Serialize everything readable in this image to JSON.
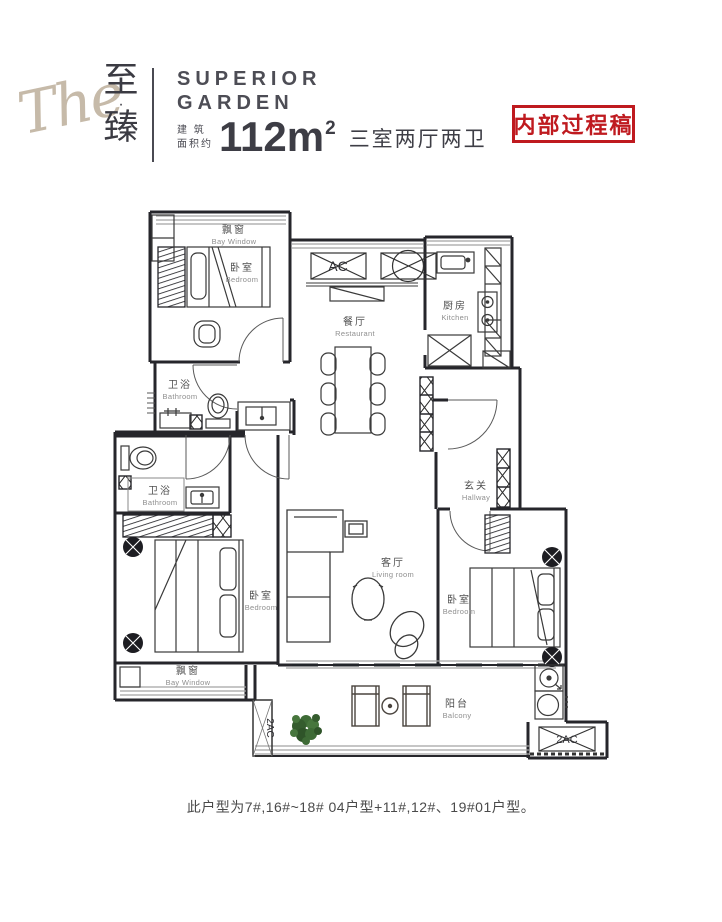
{
  "header": {
    "logo": {
      "script": "The",
      "cn_top": "至",
      "cn_dot": "·",
      "cn_bottom": "臻"
    },
    "brand": {
      "line1": "SUPERIOR",
      "line2": "GARDEN"
    },
    "area": {
      "prefix_line1": "建 筑",
      "prefix_line2": "面积约",
      "value": "112m",
      "sup": "2",
      "rooms": "三室两厅两卫"
    },
    "stamp": {
      "text": "内部过程稿",
      "color": "#bf1a1f"
    }
  },
  "floorplan": {
    "labels": {
      "bay_window_top": {
        "cn": "飘窗",
        "en": "Bay Window"
      },
      "bedroom_top_left": {
        "cn": "卧室",
        "en": "Bedroom"
      },
      "restaurant": {
        "cn": "餐厅",
        "en": "Restaurant"
      },
      "kitchen": {
        "cn": "厨房",
        "en": "Kitchen"
      },
      "bathroom_upper": {
        "cn": "卫浴",
        "en": "Bathroom"
      },
      "bathroom_lower": {
        "cn": "卫浴",
        "en": "Bathroom"
      },
      "hallway": {
        "cn": "玄关",
        "en": "Hallway"
      },
      "bedroom_bottom_left": {
        "cn": "卧室",
        "en": "Bedroom"
      },
      "living_room": {
        "cn": "客厅",
        "en": "Living room"
      },
      "bedroom_bottom_right": {
        "cn": "卧室",
        "en": "Bedroom"
      },
      "bay_window_bottom": {
        "cn": "飘窗",
        "en": "Bay Window"
      },
      "balcony": {
        "cn": "阳台",
        "en": "Balcony"
      }
    },
    "equipment": {
      "ac": "AC",
      "ac2_left": "2AC",
      "ac2_right": "2AC"
    }
  },
  "footer": {
    "note": "此户型为7#,16#~18#  04户型+11#,12#、19#01户型。"
  },
  "colors": {
    "stamp_red": "#bf1a1f",
    "logo_tan": "#c6baa9",
    "ink": "#3d3d45",
    "plant_green": "#3e6b36"
  }
}
